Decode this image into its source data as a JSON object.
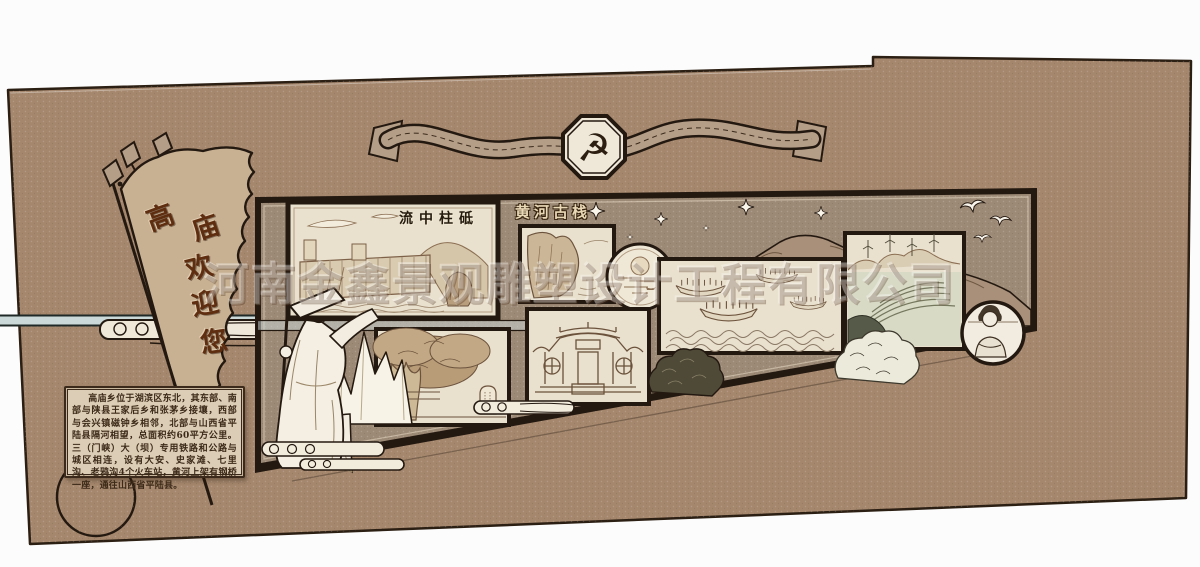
{
  "watermark": {
    "text": "河南金鑫景观雕塑设计工程有限公司"
  },
  "top_banner": {
    "emblem_glyph": "☭"
  },
  "welcome_flag": {
    "chars": [
      "高",
      "庙",
      "欢",
      "迎",
      "您"
    ],
    "full_text": "高庙欢迎您"
  },
  "panels": {
    "dam": {
      "title": "流中柱砥"
    },
    "cliff": {
      "title": "黄河古栈"
    }
  },
  "info_plaque": {
    "text": "高庙乡位于湖滨区东北，其东部、南部与陕县王家后乡和张茅乡接壤，西部与会兴镇磁钟乡相邻，北部与山西省平陆县隔河相望，总面积约60平方公里。三（门峡）大（坝）专用铁路和公路与城区相连，设有大安、史家滩、七里沟、老鸦沟4个火车站，黄河上架有钢桥一座，通往山西省平陆县。"
  },
  "colors": {
    "wall": "#a5876d",
    "band": "#9d8a76",
    "frame": "#241910",
    "panel_bg": "#e9e0cd",
    "ribbon": "#b59e88",
    "emblem_bg": "#efe7d8",
    "pennant": "#c8b193",
    "flag_text": "#5f2d10",
    "plaque_bg": "#dccdb6",
    "plaque_border": "#3b2a1b",
    "rail": "#ccd9d9",
    "etch": "#8a6e52"
  }
}
